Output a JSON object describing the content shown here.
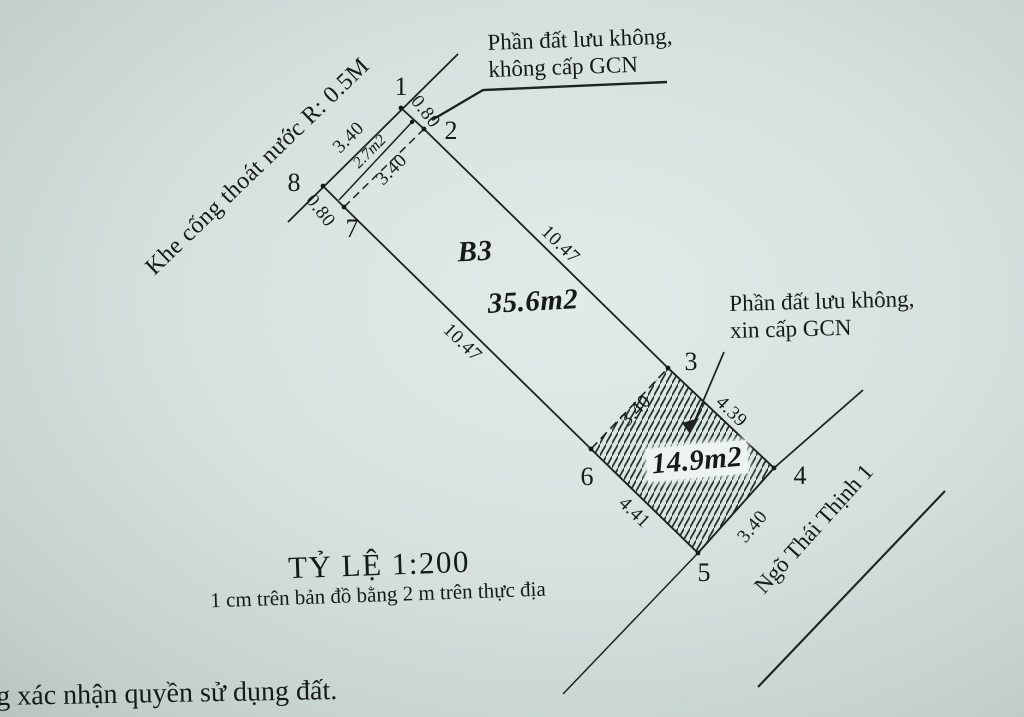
{
  "colors": {
    "paper": "#d6e1de",
    "ink": "#1d2120"
  },
  "notes": {
    "reserved_top": {
      "line1": "Phần đất lưu không,",
      "line2": "không cấp GCN"
    },
    "reserved_right": {
      "line1": "Phần đất lưu không,",
      "line2": "xin cấp GCN"
    },
    "drain_channel": "Khe cống thoát nước R: 0.5M",
    "road_name": "Ngõ Thái Thịnh 1",
    "bottom_caption": "g xác nhận quyền sử dụng đất."
  },
  "scale_bar": {
    "title": "TỶ LỆ 1:200",
    "subtitle": "1 cm trên bản đồ bằng 2 m trên thực địa"
  },
  "parcels": {
    "main": {
      "label": "B3",
      "area": "35.6m2"
    },
    "strip": {
      "area": "2.7m2"
    },
    "hatched": {
      "area": "14.9m2"
    }
  },
  "points": {
    "p1": "1",
    "p2": "2",
    "p3": "3",
    "p4": "4",
    "p5": "5",
    "p6": "6",
    "p7": "7",
    "p8": "8"
  },
  "dimensions": {
    "edge_1_8": "3.40",
    "edge_2_7": "3.40",
    "edge_1_2": "0.80",
    "edge_8_7": "0.80",
    "edge_2_3": "10.47",
    "edge_7_6": "10.47",
    "edge_6_3": "3.40",
    "edge_3_4": "4.39",
    "edge_4_5": "3.40",
    "edge_6_5": "4.41"
  }
}
